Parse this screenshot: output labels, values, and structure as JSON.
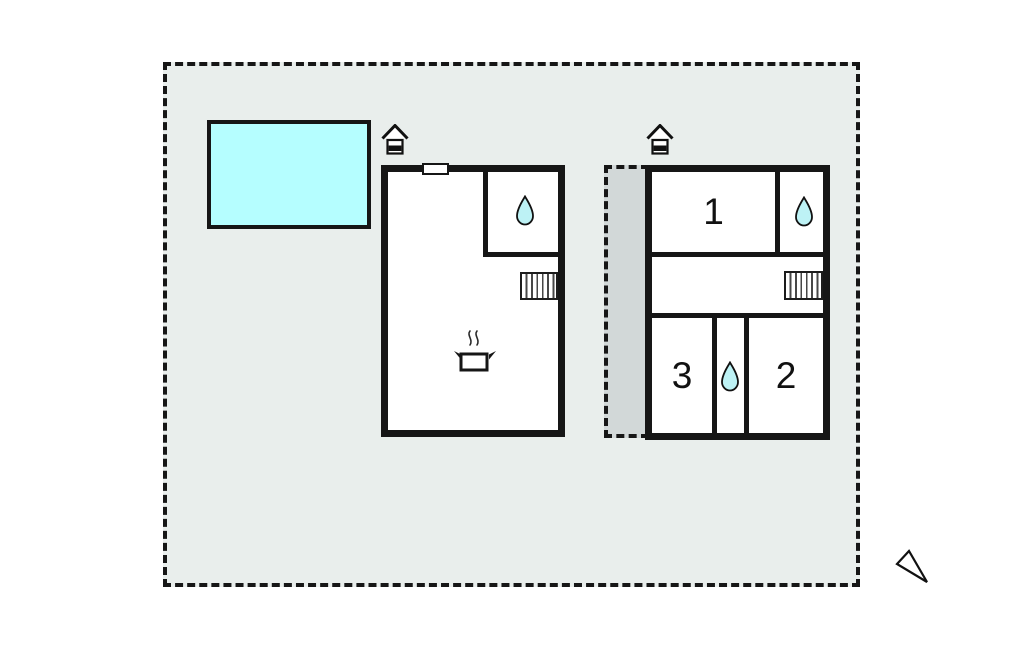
{
  "colors": {
    "plot_fill": "#e9eeec",
    "terrace_fill": "#d2d8d8",
    "pool_fill": "#b5feff",
    "water_drop": "#bdf2f5",
    "wall": "#161616"
  },
  "rooms": {
    "room1": "1",
    "room2": "2",
    "room3": "3"
  },
  "icons": {
    "entrance": "house-entrance-icon",
    "water": "water-drop-icon",
    "stairs": "stairs-icon",
    "cooking": "cooking-pot-icon",
    "compass": "north-arrow-icon"
  }
}
